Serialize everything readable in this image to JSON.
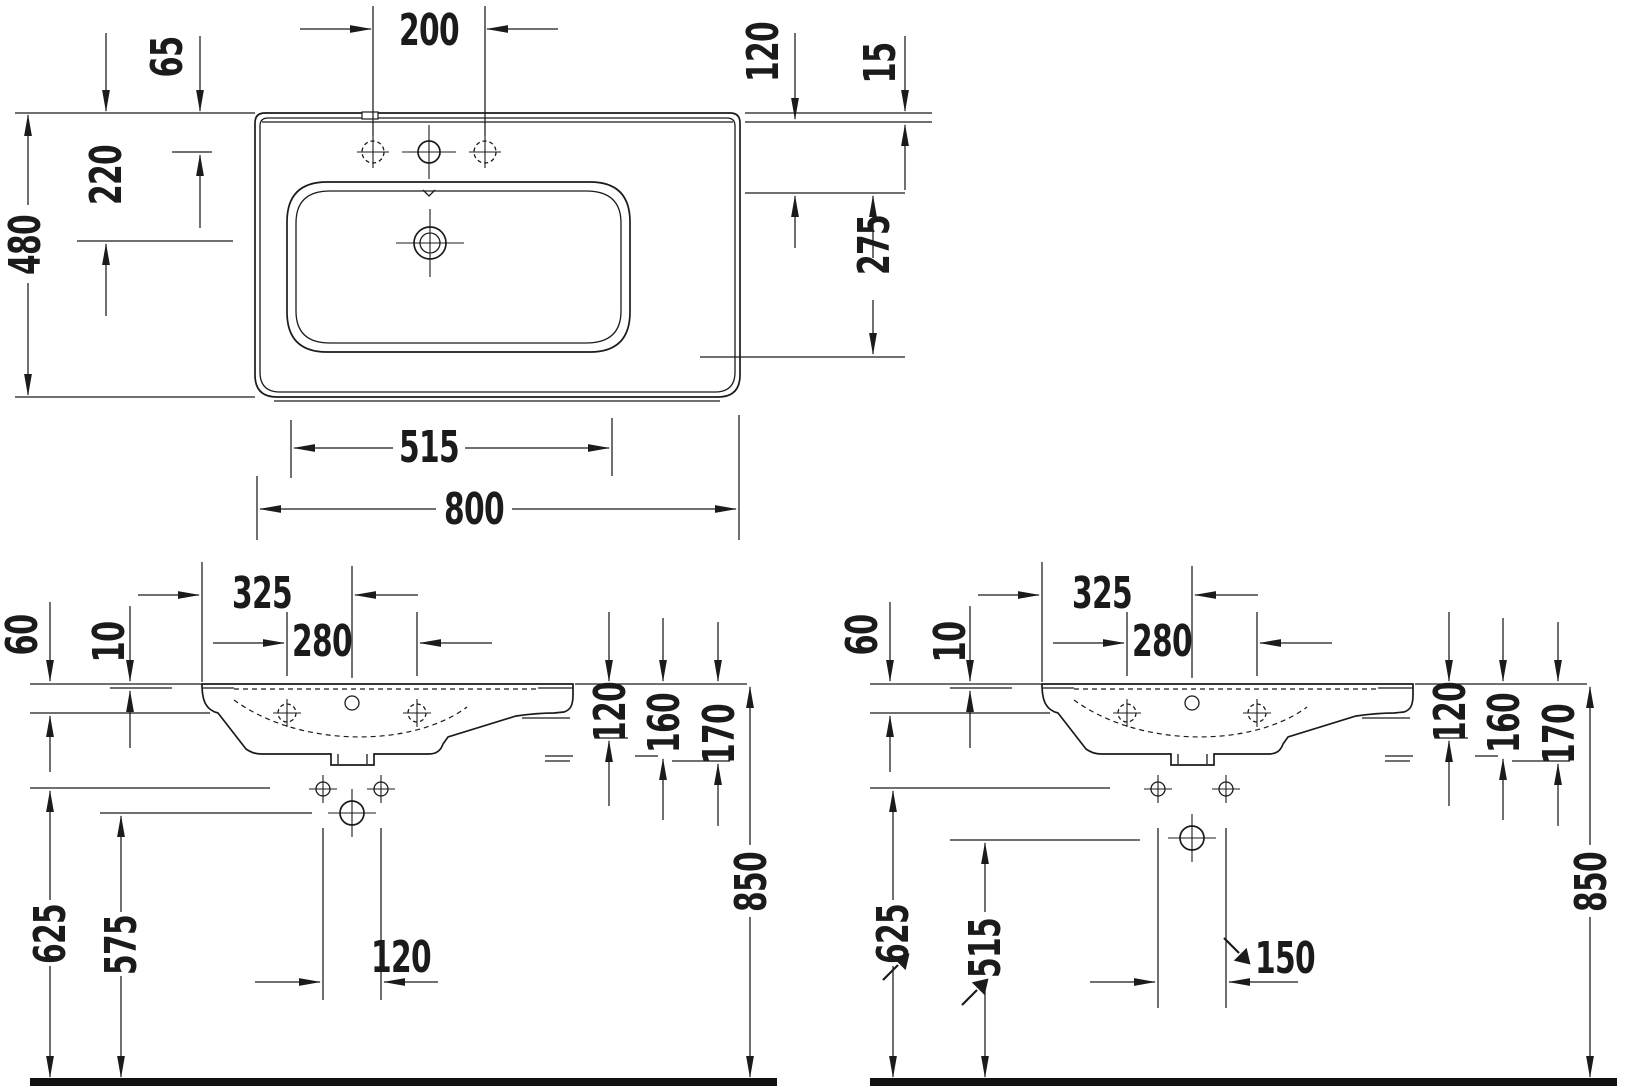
{
  "drawing": {
    "background": "#ffffff",
    "line_color": "#1b1b1b",
    "plan": {
      "d480": "480",
      "d65": "65",
      "d220": "220",
      "d200": "200",
      "d120": "120",
      "d15": "15",
      "d275": "275",
      "d515": "515",
      "d800": "800"
    },
    "frontA": {
      "d60": "60",
      "d10": "10",
      "d325": "325",
      "d280": "280",
      "d120_deck": "120",
      "d160": "160",
      "d170": "170",
      "d850": "850",
      "d625": "625",
      "d575": "575",
      "d120_holes": "120"
    },
    "frontB": {
      "d60": "60",
      "d10": "10",
      "d325": "325",
      "d280": "280",
      "d120_deck": "120",
      "d160": "160",
      "d170": "170",
      "d850": "850",
      "d625": "625",
      "d515": "515",
      "d150": "150"
    }
  }
}
